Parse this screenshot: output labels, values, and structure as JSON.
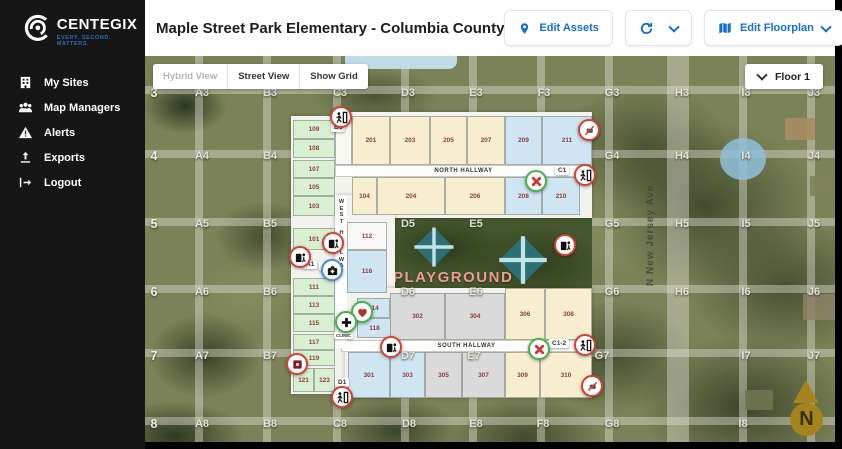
{
  "sidebar": {
    "logo_title": "CENTEGIX",
    "logo_tagline": "EVERY. SECOND. MATTERS.",
    "items": [
      {
        "label": "My Sites",
        "icon": "building-icon"
      },
      {
        "label": "Map Managers",
        "icon": "people-icon"
      },
      {
        "label": "Alerts",
        "icon": "warning-icon"
      },
      {
        "label": "Exports",
        "icon": "upload-icon"
      },
      {
        "label": "Logout",
        "icon": "logout-icon"
      }
    ]
  },
  "header": {
    "title": "Maple Street Park Elementary - Columbia County",
    "buttons": {
      "edit_assets": "Edit Assets",
      "edit_floorplan": "Edit Floorplan",
      "back": "Back"
    }
  },
  "map": {
    "controls": {
      "hybrid": "Hybrid View",
      "street": "Street View",
      "grid": "Show Grid",
      "floor": "Floor 1"
    },
    "street_name": "N New Jersey Ave",
    "playground_label": "PLAYGROUND",
    "north_label": "N",
    "hallways": {
      "north": "NORTH HALLWAY",
      "south": "SOUTH HALLWAY",
      "west": "WEST HALLWAY"
    },
    "colors": {
      "accent_blue": "#1270cc",
      "marker_red": "#cf4436",
      "marker_green": "#4caf50",
      "marker_blue": "#4a90d9",
      "logo_blue": "#2f6fb5",
      "compass_gold": "#a5831f"
    },
    "grid_labels": [
      {
        "t": "3",
        "x": 9,
        "y": 37,
        "big": true
      },
      {
        "t": "4",
        "x": 9,
        "y": 100,
        "big": true
      },
      {
        "t": "5",
        "x": 9,
        "y": 168,
        "big": true
      },
      {
        "t": "6",
        "x": 9,
        "y": 236,
        "big": true
      },
      {
        "t": "7",
        "x": 9,
        "y": 300,
        "big": true
      },
      {
        "t": "8",
        "x": 9,
        "y": 368,
        "big": true
      },
      {
        "t": "A3",
        "x": 57,
        "y": 37
      },
      {
        "t": "B3",
        "x": 125,
        "y": 37
      },
      {
        "t": "C3",
        "x": 195,
        "y": 37
      },
      {
        "t": "D3",
        "x": 263,
        "y": 37
      },
      {
        "t": "E3",
        "x": 331,
        "y": 37
      },
      {
        "t": "F3",
        "x": 399,
        "y": 37
      },
      {
        "t": "G3",
        "x": 467,
        "y": 37
      },
      {
        "t": "H3",
        "x": 537,
        "y": 37
      },
      {
        "t": "I3",
        "x": 601,
        "y": 37
      },
      {
        "t": "J3",
        "x": 669,
        "y": 37
      },
      {
        "t": "A4",
        "x": 57,
        "y": 100
      },
      {
        "t": "B4",
        "x": 125,
        "y": 100
      },
      {
        "t": "G4",
        "x": 467,
        "y": 100
      },
      {
        "t": "H4",
        "x": 537,
        "y": 100
      },
      {
        "t": "I4",
        "x": 601,
        "y": 100
      },
      {
        "t": "J4",
        "x": 669,
        "y": 100
      },
      {
        "t": "A5",
        "x": 57,
        "y": 168
      },
      {
        "t": "B5",
        "x": 125,
        "y": 168
      },
      {
        "t": "D5",
        "x": 263,
        "y": 168
      },
      {
        "t": "E5",
        "x": 331,
        "y": 168
      },
      {
        "t": "G5",
        "x": 467,
        "y": 168
      },
      {
        "t": "H5",
        "x": 537,
        "y": 168
      },
      {
        "t": "I5",
        "x": 601,
        "y": 168
      },
      {
        "t": "J5",
        "x": 669,
        "y": 168
      },
      {
        "t": "A6",
        "x": 57,
        "y": 236
      },
      {
        "t": "B6",
        "x": 125,
        "y": 236
      },
      {
        "t": "D6",
        "x": 263,
        "y": 236
      },
      {
        "t": "E6",
        "x": 331,
        "y": 236
      },
      {
        "t": "G6",
        "x": 467,
        "y": 236
      },
      {
        "t": "H6",
        "x": 537,
        "y": 236
      },
      {
        "t": "I6",
        "x": 601,
        "y": 236
      },
      {
        "t": "J6",
        "x": 669,
        "y": 236
      },
      {
        "t": "A7",
        "x": 57,
        "y": 300
      },
      {
        "t": "B7",
        "x": 125,
        "y": 300
      },
      {
        "t": "D7",
        "x": 263,
        "y": 300
      },
      {
        "t": "E7",
        "x": 329,
        "y": 300
      },
      {
        "t": "G7",
        "x": 457,
        "y": 300
      },
      {
        "t": "I7",
        "x": 601,
        "y": 300
      },
      {
        "t": "J7",
        "x": 669,
        "y": 300
      },
      {
        "t": "A8",
        "x": 57,
        "y": 368
      },
      {
        "t": "B8",
        "x": 125,
        "y": 368
      },
      {
        "t": "C8",
        "x": 195,
        "y": 368
      },
      {
        "t": "D8",
        "x": 264,
        "y": 368
      },
      {
        "t": "E8",
        "x": 331,
        "y": 368
      },
      {
        "t": "F8",
        "x": 398,
        "y": 368
      },
      {
        "t": "G8",
        "x": 467,
        "y": 368
      },
      {
        "t": "I8",
        "x": 598,
        "y": 368
      }
    ],
    "chips": [
      {
        "t": "B1",
        "x": 186,
        "y": 67
      },
      {
        "t": "C1",
        "x": 410,
        "y": 110
      },
      {
        "t": "A1",
        "x": 158,
        "y": 204
      },
      {
        "t": "100",
        "x": 174,
        "y": 206
      },
      {
        "t": "C1-2",
        "x": 404,
        "y": 283
      },
      {
        "t": "D1",
        "x": 190,
        "y": 322
      }
    ],
    "rooms": [
      {
        "n": "",
        "x": 190,
        "y": 60,
        "w": 17,
        "h": 49,
        "c": "white"
      },
      {
        "n": "201",
        "x": 207,
        "y": 60,
        "w": 38,
        "h": 49,
        "c": "cream"
      },
      {
        "n": "203",
        "x": 245,
        "y": 60,
        "w": 40,
        "h": 49,
        "c": "cream"
      },
      {
        "n": "205",
        "x": 285,
        "y": 60,
        "w": 37,
        "h": 49,
        "c": "cream"
      },
      {
        "n": "207",
        "x": 322,
        "y": 60,
        "w": 38,
        "h": 49,
        "c": "cream"
      },
      {
        "n": "209",
        "x": 360,
        "y": 60,
        "w": 37,
        "h": 49,
        "c": "blue"
      },
      {
        "n": "211",
        "x": 397,
        "y": 60,
        "w": 50,
        "h": 49,
        "c": "blue"
      },
      {
        "n": "104",
        "x": 207,
        "y": 121,
        "w": 25,
        "h": 38,
        "c": "cream"
      },
      {
        "n": "204",
        "x": 232,
        "y": 121,
        "w": 68,
        "h": 38,
        "c": "cream"
      },
      {
        "n": "206",
        "x": 300,
        "y": 121,
        "w": 60,
        "h": 38,
        "c": "cream"
      },
      {
        "n": "208",
        "x": 360,
        "y": 121,
        "w": 37,
        "h": 38,
        "c": "blue"
      },
      {
        "n": "210",
        "x": 397,
        "y": 121,
        "w": 38,
        "h": 38,
        "c": "blue"
      },
      {
        "n": "109",
        "x": 148,
        "y": 64,
        "w": 42,
        "h": 19,
        "c": "green"
      },
      {
        "n": "108",
        "x": 148,
        "y": 83,
        "w": 42,
        "h": 19,
        "c": "green"
      },
      {
        "n": "107",
        "x": 148,
        "y": 104,
        "w": 42,
        "h": 18,
        "c": "green"
      },
      {
        "n": "105",
        "x": 148,
        "y": 122,
        "w": 42,
        "h": 18,
        "c": "green"
      },
      {
        "n": "103",
        "x": 148,
        "y": 140,
        "w": 42,
        "h": 20,
        "c": "green"
      },
      {
        "n": "101",
        "x": 148,
        "y": 172,
        "w": 42,
        "h": 22,
        "c": "green"
      },
      {
        "n": "111",
        "x": 148,
        "y": 222,
        "w": 42,
        "h": 18,
        "c": "green"
      },
      {
        "n": "113",
        "x": 148,
        "y": 240,
        "w": 42,
        "h": 18,
        "c": "green"
      },
      {
        "n": "115",
        "x": 148,
        "y": 258,
        "w": 42,
        "h": 18,
        "c": "green"
      },
      {
        "n": "117",
        "x": 148,
        "y": 278,
        "w": 42,
        "h": 16,
        "c": "green"
      },
      {
        "n": "119",
        "x": 148,
        "y": 294,
        "w": 42,
        "h": 16,
        "c": "green"
      },
      {
        "n": "121",
        "x": 148,
        "y": 312,
        "w": 21,
        "h": 24,
        "c": "green"
      },
      {
        "n": "123",
        "x": 169,
        "y": 312,
        "w": 21,
        "h": 24,
        "c": "green"
      },
      {
        "n": "112",
        "x": 202,
        "y": 166,
        "w": 40,
        "h": 28,
        "c": "white"
      },
      {
        "n": "116",
        "x": 202,
        "y": 194,
        "w": 40,
        "h": 43,
        "c": "blue"
      },
      {
        "n": "114",
        "x": 212,
        "y": 242,
        "w": 33,
        "h": 20,
        "c": "blue"
      },
      {
        "n": "118",
        "x": 212,
        "y": 262,
        "w": 35,
        "h": 20,
        "c": "blue"
      },
      {
        "n": "302",
        "x": 245,
        "y": 237,
        "w": 55,
        "h": 47,
        "c": "gray"
      },
      {
        "n": "304",
        "x": 300,
        "y": 237,
        "w": 60,
        "h": 47,
        "c": "gray"
      },
      {
        "n": "306",
        "x": 360,
        "y": 232,
        "w": 40,
        "h": 52,
        "c": "cream"
      },
      {
        "n": "308",
        "x": 400,
        "y": 232,
        "w": 47,
        "h": 52,
        "c": "cream"
      },
      {
        "n": "301",
        "x": 203,
        "y": 296,
        "w": 42,
        "h": 46,
        "c": "blue"
      },
      {
        "n": "303",
        "x": 245,
        "y": 296,
        "w": 35,
        "h": 46,
        "c": "blue"
      },
      {
        "n": "305",
        "x": 280,
        "y": 296,
        "w": 37,
        "h": 46,
        "c": "gray"
      },
      {
        "n": "307",
        "x": 317,
        "y": 296,
        "w": 43,
        "h": 46,
        "c": "gray"
      },
      {
        "n": "309",
        "x": 360,
        "y": 296,
        "w": 35,
        "h": 46,
        "c": "cream"
      },
      {
        "n": "310",
        "x": 395,
        "y": 296,
        "w": 52,
        "h": 46,
        "c": "cream"
      }
    ],
    "markers": [
      {
        "icon": "exit-run-icon",
        "x": 196,
        "y": 61
      },
      {
        "icon": "no-access-icon",
        "x": 444,
        "y": 74
      },
      {
        "icon": "x-mark-icon",
        "x": 391,
        "y": 125
      },
      {
        "icon": "exit-run-icon",
        "x": 440,
        "y": 119
      },
      {
        "icon": "alert-device-icon",
        "x": 188,
        "y": 187
      },
      {
        "icon": "alert-device-icon",
        "x": 155,
        "y": 201
      },
      {
        "icon": "alert-device-icon",
        "x": 420,
        "y": 189
      },
      {
        "icon": "first-aid-icon",
        "x": 187,
        "y": 214
      },
      {
        "icon": "heart-icon",
        "x": 217,
        "y": 256
      },
      {
        "icon": "clinic-icon",
        "x": 201,
        "y": 266,
        "label": "CLINIC"
      },
      {
        "icon": "alert-device-icon",
        "x": 246,
        "y": 291
      },
      {
        "icon": "fire-alarm-icon",
        "x": 152,
        "y": 308
      },
      {
        "icon": "x-mark-icon",
        "x": 394,
        "y": 293
      },
      {
        "icon": "exit-run-icon",
        "x": 440,
        "y": 289
      },
      {
        "icon": "no-access-icon",
        "x": 447,
        "y": 330
      },
      {
        "icon": "exit-run-icon",
        "x": 197,
        "y": 341
      }
    ]
  }
}
